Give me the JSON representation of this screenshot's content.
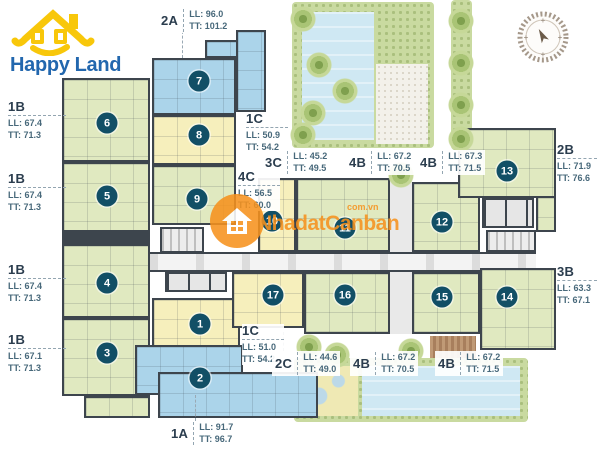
{
  "brand": {
    "word1": "Happy",
    "word2": "Land"
  },
  "watermark": {
    "name": "NhadatCanban",
    "domain": "com.vn"
  },
  "colors": {
    "green": "#e0e9c0",
    "blue": "#abd4ea",
    "yellow": "#f6efbc",
    "wall": "#3d454d",
    "badge": "#124f66",
    "orange": "#f6921e",
    "logoBlue": "#2267ae",
    "labelDark": "#2b3d4e",
    "labelTeal": "#47687a",
    "water": "#cfe8f3",
    "fringe": "#c9daa0",
    "sand": "#efe9b4"
  },
  "units": [
    {
      "n": "1",
      "x": 200,
      "y": 324
    },
    {
      "n": "2",
      "x": 200,
      "y": 378
    },
    {
      "n": "3",
      "x": 107,
      "y": 353
    },
    {
      "n": "4",
      "x": 107,
      "y": 283
    },
    {
      "n": "5",
      "x": 107,
      "y": 196
    },
    {
      "n": "6",
      "x": 107,
      "y": 123
    },
    {
      "n": "7",
      "x": 199,
      "y": 81
    },
    {
      "n": "8",
      "x": 199,
      "y": 135
    },
    {
      "n": "9",
      "x": 197,
      "y": 199
    },
    {
      "n": "10",
      "x": 272,
      "y": 221
    },
    {
      "n": "11",
      "x": 345,
      "y": 228
    },
    {
      "n": "12",
      "x": 442,
      "y": 222
    },
    {
      "n": "13",
      "x": 507,
      "y": 171
    },
    {
      "n": "14",
      "x": 507,
      "y": 297
    },
    {
      "n": "15",
      "x": 442,
      "y": 297
    },
    {
      "n": "16",
      "x": 345,
      "y": 295
    },
    {
      "n": "17",
      "x": 273,
      "y": 295
    }
  ],
  "unit_labels": [
    {
      "type": "2A",
      "ll": "LL: 96.0",
      "tt": "TT: 101.2",
      "layout": "row",
      "x": 158,
      "y": 8
    },
    {
      "type": "1B",
      "ll": "LL: 67.4",
      "tt": "TT: 71.3",
      "layout": "stack",
      "side": "left",
      "x": 8,
      "y": 100
    },
    {
      "type": "1B",
      "ll": "LL: 67.4",
      "tt": "TT: 71.3",
      "layout": "stack",
      "side": "left",
      "x": 8,
      "y": 172
    },
    {
      "type": "1B",
      "ll": "LL: 67.4",
      "tt": "TT: 71.3",
      "layout": "stack",
      "side": "left",
      "x": 8,
      "y": 263
    },
    {
      "type": "1B",
      "ll": "LL: 67.1",
      "tt": "TT: 71.3",
      "layout": "stack",
      "side": "left",
      "x": 8,
      "y": 333
    },
    {
      "type": "1C",
      "ll": "LL: 50.9",
      "tt": "TT: 54.2",
      "layout": "stack",
      "side": "mid",
      "x": 246,
      "y": 112
    },
    {
      "type": "4C",
      "ll": "LL: 56.5",
      "tt": "TT: 60.0",
      "layout": "stack",
      "side": "mid",
      "x": 238,
      "y": 170
    },
    {
      "type": "3C",
      "ll": "LL: 45.2",
      "tt": "TT: 49.5",
      "layout": "row",
      "x": 262,
      "y": 150
    },
    {
      "type": "4B",
      "ll": "LL: 67.2",
      "tt": "TT: 70.5",
      "layout": "row",
      "x": 346,
      "y": 150
    },
    {
      "type": "4B",
      "ll": "LL: 67.3",
      "tt": "TT: 71.5",
      "layout": "row",
      "x": 417,
      "y": 150
    },
    {
      "type": "2B",
      "ll": "LL: 71.9",
      "tt": "TT: 76.6",
      "layout": "stack",
      "side": "right",
      "x": 557,
      "y": 143
    },
    {
      "type": "3B",
      "ll": "LL: 63.3",
      "tt": "TT: 67.1",
      "layout": "stack",
      "side": "right",
      "x": 557,
      "y": 265
    },
    {
      "type": "1C",
      "ll": "LL: 51.0",
      "tt": "TT: 54.2",
      "layout": "stack",
      "side": "mid",
      "x": 242,
      "y": 324
    },
    {
      "type": "2C",
      "ll": "LL: 44.6",
      "tt": "TT: 49.0",
      "layout": "row",
      "x": 272,
      "y": 351
    },
    {
      "type": "4B",
      "ll": "LL: 67.2",
      "tt": "TT: 70.5",
      "layout": "row",
      "x": 350,
      "y": 351
    },
    {
      "type": "4B",
      "ll": "LL: 67.2",
      "tt": "TT: 71.5",
      "layout": "row",
      "x": 435,
      "y": 351
    },
    {
      "type": "1A",
      "ll": "LL: 91.7",
      "tt": "TT: 96.7",
      "layout": "row",
      "x": 168,
      "y": 421
    }
  ]
}
